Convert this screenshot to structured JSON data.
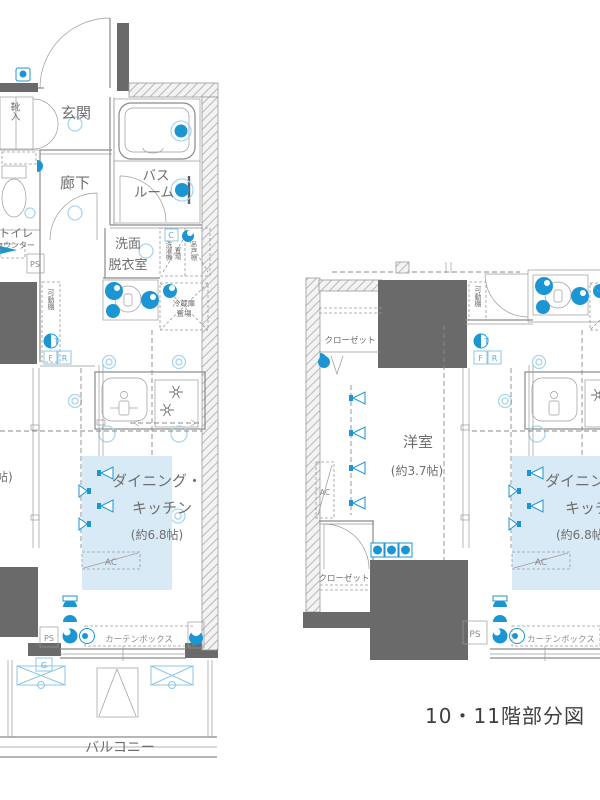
{
  "caption": "10・11階部分図",
  "colors": {
    "accent_blue": "#1b96d3",
    "light_blue_fill": "#d9eaf7",
    "wall_gray": "#6a6a6a",
    "line_gray": "#8a8a8a",
    "label_blue": "#5aaede"
  },
  "left_plan": {
    "rooms": {
      "genkan": "玄関",
      "hallway": "廊下",
      "bath_line1": "バス",
      "bath_line2": "ルーム",
      "toilet": "トイレ",
      "toilet_counter": "カウンター",
      "washroom_line1": "洗面",
      "washroom_line2": "脱衣室",
      "dk_line1": "ダイニング・",
      "dk_line2": "キッチン",
      "dk_size": "(約6.8帖)",
      "balcony": "バルコニー",
      "cut_room_size": "帖)"
    },
    "fixtures": {
      "shoe_cabinet": "靴入",
      "movable_shelf": "可動棚",
      "washer": "洗濯機",
      "washer_place": "置場",
      "hanging_cupboard": "吊戸棚",
      "fridge_line1": "冷蔵庫",
      "fridge_line2": "置場",
      "curtain_box": "カーテンボックス"
    },
    "tags": {
      "ps_upper": "PS",
      "ps_lower": "PS",
      "ac": "AC",
      "t": "T",
      "f": "F",
      "r": "R",
      "c": "C",
      "g": "G"
    }
  },
  "right_plan": {
    "rooms": {
      "closet_upper": "クローゼット",
      "closet_lower": "クローゼット",
      "western_room": "洋室",
      "western_room_size": "(約3.7帖)",
      "dk_line1": "ダイニング・",
      "dk_line2": "キッチン",
      "dk_size": "(約6.8帖)"
    },
    "fixtures": {
      "movable_shelf": "可動棚",
      "curtain_box": "カーテンボックス"
    },
    "tags": {
      "ps": "PS",
      "ac_side": "AC",
      "ac_main": "AC",
      "t": "T",
      "f": "F",
      "r": "R"
    }
  }
}
